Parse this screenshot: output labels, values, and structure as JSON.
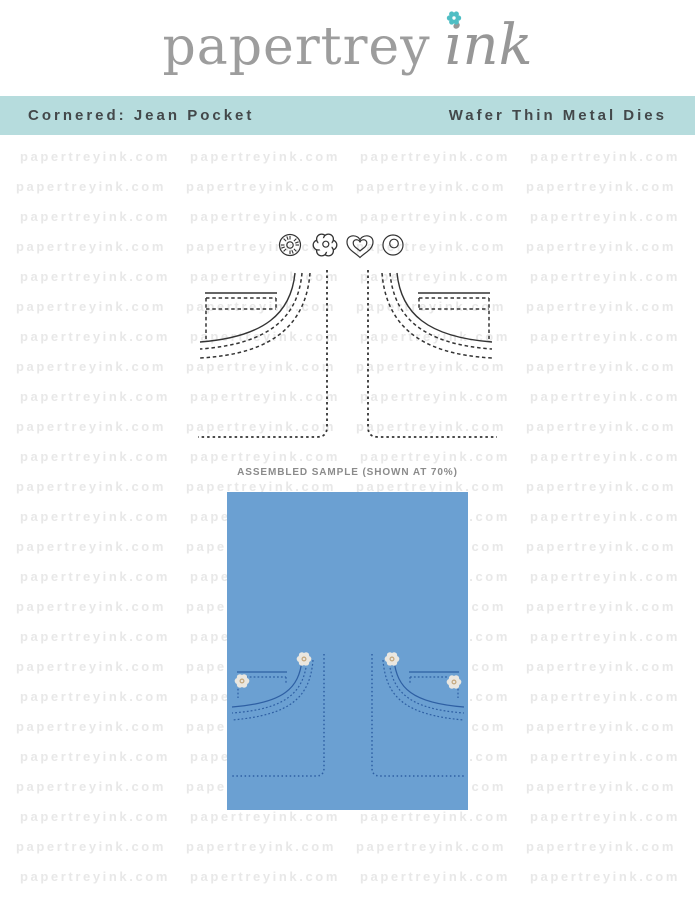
{
  "brand": {
    "logo_serif": "papertrey",
    "logo_script": "ink"
  },
  "banner": {
    "product_name": "Cornered: Jean Pocket",
    "product_type": "Wafer Thin Metal Dies"
  },
  "watermark": {
    "text": "papertreyink.com",
    "rows": 25,
    "cols": 4
  },
  "sample": {
    "label": "ASSEMBLED SAMPLE (SHOWN AT 70%)"
  },
  "dies": {
    "small_shapes": [
      "stitched-button",
      "flower",
      "heart",
      "grommet"
    ],
    "main_shapes": [
      "left-jean-pocket-corner",
      "right-jean-pocket-corner"
    ]
  },
  "colors": {
    "banner_bg": "#b6dcdd",
    "banner_text": "#43484a",
    "card_blue": "#6ba0d2",
    "stitch_blue": "#2e5fa3",
    "die_line": "#333333",
    "logo_gray": "#9d9d9d",
    "logo_flower_teal": "#4fbec4",
    "watermark_gray": "#e8e8e8",
    "label_gray": "#8b8b8b",
    "flower_petal": "#eae7e0",
    "flower_center": "#c4a87e"
  }
}
